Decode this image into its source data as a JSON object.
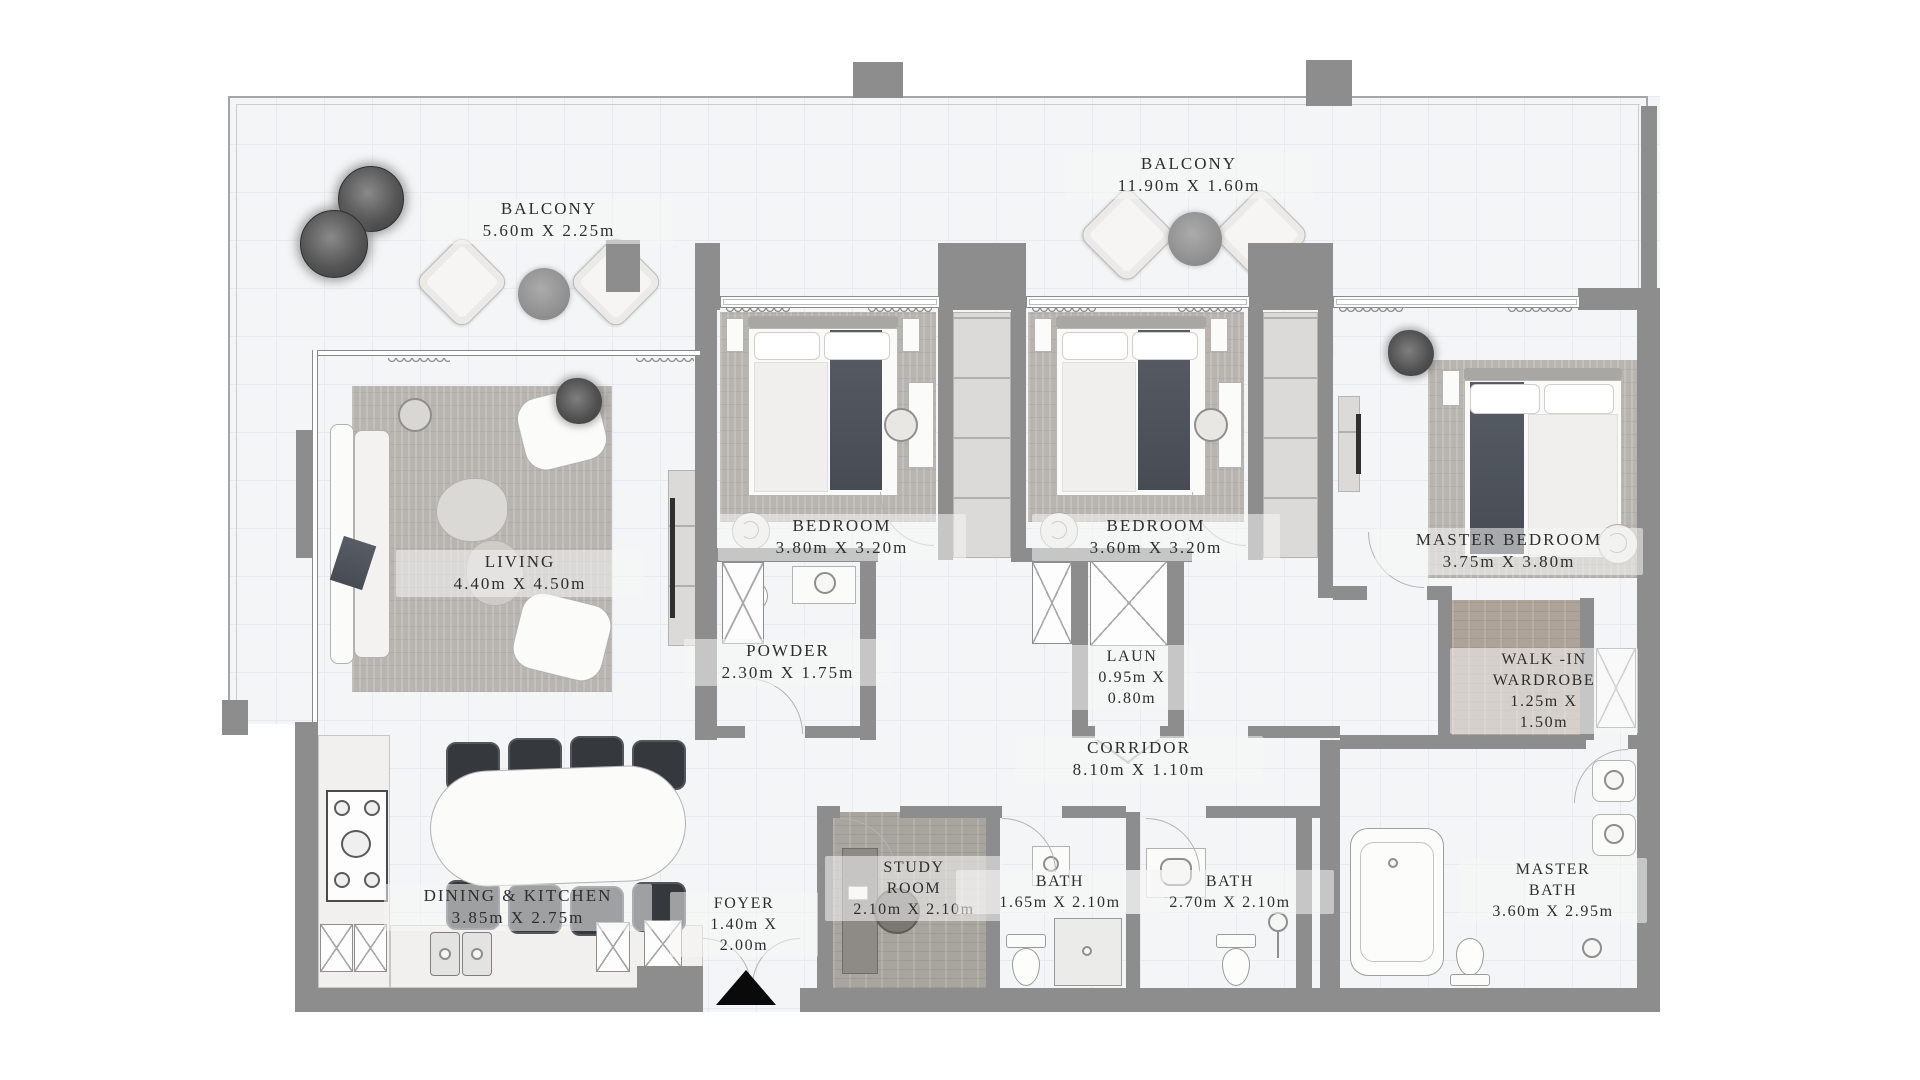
{
  "plan": {
    "type": "apartment-floor-plan",
    "colors": {
      "wall": "#8d8d8d",
      "floor": "#f4f5f6",
      "grid": "#eaeaee",
      "text": "#2e2e2e",
      "furniture_dark": "#35383d",
      "bed_throw": "#4d525b",
      "rug": "#b8b5b0",
      "entrance_marker": "#0a0a0a"
    },
    "rooms": {
      "balcony_left": {
        "lines": [
          "BALCONY",
          "5.60m X 2.25m"
        ]
      },
      "balcony_top": {
        "lines": [
          "BALCONY",
          "11.90m X 1.60m"
        ]
      },
      "living": {
        "lines": [
          "LIVING",
          "4.40m X 4.50m"
        ]
      },
      "bedroom_1": {
        "lines": [
          "BEDROOM",
          "3.80m X 3.20m"
        ]
      },
      "bedroom_2": {
        "lines": [
          "BEDROOM",
          "3.60m X 3.20m"
        ]
      },
      "master_bedroom": {
        "lines": [
          "MASTER BEDROOM",
          "3.75m X 3.80m"
        ]
      },
      "powder": {
        "lines": [
          "POWDER",
          "2.30m X 1.75m"
        ]
      },
      "laundry": {
        "lines": [
          "LAUN",
          "0.95m X",
          "0.80m"
        ]
      },
      "corridor": {
        "lines": [
          "CORRIDOR",
          "8.10m X 1.10m"
        ]
      },
      "walk_in_wardrobe": {
        "lines": [
          "WALK -IN",
          "WARDROBE",
          "1.25m X",
          "1.50m"
        ]
      },
      "dining_kitchen": {
        "lines": [
          "DINING & KITCHEN",
          "3.85m X 2.75m"
        ]
      },
      "foyer": {
        "lines": [
          "FOYER",
          "1.40m X",
          "2.00m"
        ]
      },
      "study_room": {
        "lines": [
          "STUDY",
          "ROOM",
          "2.10m X 2.10m"
        ]
      },
      "bath_1": {
        "lines": [
          "BATH",
          "1.65m X 2.10m"
        ]
      },
      "bath_2": {
        "lines": [
          "BATH",
          "2.70m X 2.10m"
        ]
      },
      "master_bath": {
        "lines": [
          "MASTER",
          "BATH",
          "3.60m X 2.95m"
        ]
      }
    }
  }
}
